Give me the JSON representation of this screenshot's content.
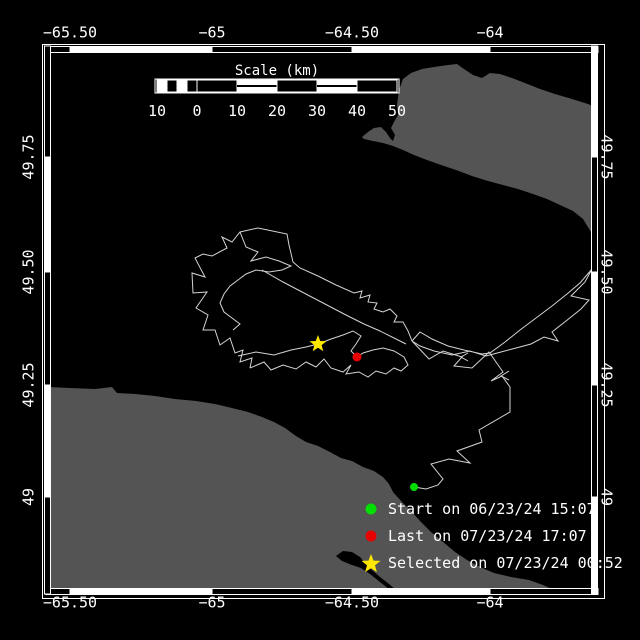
{
  "map": {
    "colors": {
      "background": "#000000",
      "land": "#545454",
      "lake": "#000000",
      "track": "#d4d4d4",
      "frame": "#ffffff",
      "start_marker": "#00dd00",
      "last_marker": "#e80000",
      "selected_marker": "#ffe800"
    },
    "axis": {
      "x_ticks": [
        {
          "label": "−65.50",
          "px": 70
        },
        {
          "label": "−65",
          "px": 212
        },
        {
          "label": "−64.50",
          "px": 352
        },
        {
          "label": "−64",
          "px": 490
        }
      ],
      "y_ticks": [
        {
          "label": "49.75",
          "px": 157
        },
        {
          "label": "49.50",
          "px": 272
        },
        {
          "label": "49.25",
          "px": 385
        },
        {
          "label": "49",
          "px": 497
        }
      ]
    },
    "frame": {
      "outer": [
        42,
        44,
        604,
        598
      ],
      "band_thickness": 6,
      "x_bounds": [
        46,
        70,
        212,
        352,
        490,
        598
      ],
      "y_bounds": [
        46,
        157,
        272,
        385,
        497,
        594
      ],
      "top_fills": [
        "B",
        "W",
        "B",
        "W",
        "B"
      ],
      "bottom_fills": [
        "B",
        "W",
        "B",
        "W",
        "B"
      ],
      "left_fills": [
        "B",
        "W",
        "B",
        "W",
        "B"
      ],
      "right_fills": [
        "W",
        "B",
        "W",
        "B",
        "W"
      ]
    },
    "scale_bar": {
      "title": "Scale (km)",
      "x0": 156,
      "x1": 398,
      "y0": 80,
      "y1": 92,
      "title_pos": [
        277,
        71
      ],
      "label_y": 111,
      "tick_labels": [
        {
          "text": "10",
          "px": 157
        },
        {
          "text": "0",
          "px": 197
        },
        {
          "text": "10",
          "px": 237
        },
        {
          "text": "20",
          "px": 277
        },
        {
          "text": "30",
          "px": 317
        },
        {
          "text": "40",
          "px": 357
        },
        {
          "text": "50",
          "px": 397
        }
      ],
      "cells": [
        [
          157,
          167,
          "W"
        ],
        [
          167,
          177,
          "B"
        ],
        [
          177,
          187,
          "W"
        ],
        [
          187,
          197,
          "B"
        ],
        [
          197,
          237,
          "B"
        ],
        [
          237,
          277,
          "WS"
        ],
        [
          277,
          317,
          "B"
        ],
        [
          317,
          357,
          "WS"
        ],
        [
          357,
          397,
          "B"
        ]
      ]
    },
    "legend": [
      {
        "marker": "circle",
        "color": "#00dd00",
        "label": "Start on 06/23/24 15:07"
      },
      {
        "marker": "circle",
        "color": "#e80000",
        "label": "Last on 07/23/24 17:07"
      },
      {
        "marker": "star",
        "color": "#ffe800",
        "label": "Selected on 07/23/24 00:52"
      }
    ],
    "markers": {
      "start": {
        "x": 414,
        "y": 487,
        "r": 4
      },
      "last": {
        "x": 357,
        "y": 357,
        "r": 4.5
      },
      "selected": {
        "x": 318,
        "y": 344,
        "r": 9
      }
    },
    "land": [
      [
        [
          403,
          79
        ],
        [
          411,
          73
        ],
        [
          422,
          69
        ],
        [
          434,
          67
        ],
        [
          448,
          65
        ],
        [
          457,
          64
        ],
        [
          464,
          69
        ],
        [
          473,
          75
        ],
        [
          482,
          78
        ],
        [
          490,
          73
        ],
        [
          500,
          74
        ],
        [
          512,
          78
        ],
        [
          525,
          83
        ],
        [
          540,
          89
        ],
        [
          555,
          94
        ],
        [
          572,
          99
        ],
        [
          588,
          104
        ],
        [
          597,
          108
        ],
        [
          597,
          255
        ],
        [
          591,
          232
        ],
        [
          583,
          219
        ],
        [
          573,
          211
        ],
        [
          560,
          205
        ],
        [
          547,
          199
        ],
        [
          533,
          194
        ],
        [
          518,
          189
        ],
        [
          503,
          185
        ],
        [
          488,
          181
        ],
        [
          472,
          176
        ],
        [
          456,
          170
        ],
        [
          441,
          165
        ],
        [
          427,
          160
        ],
        [
          414,
          155
        ],
        [
          403,
          150
        ],
        [
          393,
          146
        ],
        [
          383,
          143
        ],
        [
          373,
          141
        ],
        [
          364,
          139
        ],
        [
          362,
          137
        ],
        [
          368,
          132
        ],
        [
          374,
          128
        ],
        [
          381,
          127
        ],
        [
          386,
          132
        ],
        [
          390,
          138
        ],
        [
          393,
          141
        ],
        [
          395,
          135
        ],
        [
          391,
          128
        ],
        [
          394,
          122
        ],
        [
          398,
          115
        ],
        [
          397,
          105
        ],
        [
          399,
          90
        ]
      ],
      [
        [
          48,
          387
        ],
        [
          70,
          388
        ],
        [
          95,
          389
        ],
        [
          112,
          387
        ],
        [
          117,
          393
        ],
        [
          135,
          394
        ],
        [
          155,
          396
        ],
        [
          175,
          399
        ],
        [
          196,
          401
        ],
        [
          215,
          404
        ],
        [
          232,
          408
        ],
        [
          248,
          412
        ],
        [
          262,
          417
        ],
        [
          274,
          422
        ],
        [
          285,
          428
        ],
        [
          296,
          436
        ],
        [
          306,
          442
        ],
        [
          318,
          446
        ],
        [
          330,
          452
        ],
        [
          341,
          458
        ],
        [
          352,
          461
        ],
        [
          363,
          467
        ],
        [
          374,
          471
        ],
        [
          383,
          477
        ],
        [
          389,
          484
        ],
        [
          393,
          492
        ],
        [
          402,
          502
        ],
        [
          411,
          511
        ],
        [
          421,
          522
        ],
        [
          431,
          532
        ],
        [
          442,
          541
        ],
        [
          455,
          552
        ],
        [
          467,
          560
        ],
        [
          480,
          567
        ],
        [
          494,
          573
        ],
        [
          511,
          577
        ],
        [
          529,
          580
        ],
        [
          543,
          585
        ],
        [
          552,
          589
        ],
        [
          556,
          592
        ],
        [
          48,
          592
        ]
      ]
    ],
    "lakes": [
      [
        [
          336,
          556
        ],
        [
          343,
          551
        ],
        [
          352,
          552
        ],
        [
          360,
          557
        ],
        [
          366,
          564
        ],
        [
          372,
          570
        ],
        [
          380,
          577
        ],
        [
          389,
          584
        ],
        [
          396,
          590
        ],
        [
          390,
          590
        ],
        [
          380,
          582
        ],
        [
          370,
          574
        ],
        [
          361,
          568
        ],
        [
          352,
          565
        ],
        [
          342,
          561
        ]
      ]
    ],
    "track": [
      [
        [
          414,
          487
        ],
        [
          426,
          489
        ],
        [
          438,
          485
        ],
        [
          443,
          479
        ],
        [
          431,
          464
        ],
        [
          449,
          459
        ],
        [
          470,
          463
        ],
        [
          457,
          451
        ],
        [
          482,
          442
        ],
        [
          479,
          430
        ],
        [
          510,
          412
        ],
        [
          510,
          387
        ],
        [
          502,
          376
        ],
        [
          491,
          381
        ],
        [
          503,
          372
        ],
        [
          489,
          352
        ],
        [
          472,
          368
        ],
        [
          454,
          366
        ],
        [
          462,
          357
        ],
        [
          443,
          351
        ],
        [
          429,
          359
        ],
        [
          412,
          341
        ]
      ],
      [
        [
          412,
          341
        ],
        [
          420,
          332
        ],
        [
          432,
          339
        ],
        [
          448,
          346
        ],
        [
          464,
          350
        ],
        [
          482,
          354
        ],
        [
          490,
          353
        ],
        [
          505,
          342
        ],
        [
          520,
          330
        ],
        [
          536,
          318
        ],
        [
          552,
          306
        ],
        [
          567,
          294
        ],
        [
          580,
          283
        ],
        [
          592,
          269
        ],
        [
          585,
          282
        ],
        [
          571,
          296
        ],
        [
          589,
          300
        ],
        [
          581,
          309
        ],
        [
          566,
          321
        ],
        [
          552,
          332
        ],
        [
          558,
          341
        ],
        [
          544,
          337
        ],
        [
          531,
          344
        ],
        [
          516,
          348
        ],
        [
          501,
          352
        ],
        [
          486,
          356
        ],
        [
          470,
          351
        ],
        [
          452,
          355
        ],
        [
          434,
          351
        ],
        [
          420,
          346
        ],
        [
          412,
          341
        ]
      ],
      [
        [
          258,
          228
        ],
        [
          287,
          234
        ],
        [
          289,
          245
        ],
        [
          293,
          262
        ],
        [
          300,
          268
        ],
        [
          318,
          276
        ],
        [
          336,
          285
        ],
        [
          354,
          293
        ],
        [
          362,
          291
        ],
        [
          360,
          298
        ],
        [
          370,
          295
        ],
        [
          368,
          302
        ],
        [
          377,
          303
        ],
        [
          374,
          309
        ],
        [
          383,
          312
        ],
        [
          390,
          309
        ],
        [
          397,
          316
        ],
        [
          394,
          322
        ],
        [
          403,
          322
        ],
        [
          408,
          331
        ],
        [
          412,
          341
        ]
      ],
      [
        [
          262,
          270
        ],
        [
          283,
          282
        ],
        [
          304,
          293
        ],
        [
          325,
          304
        ],
        [
          346,
          315
        ],
        [
          364,
          324
        ],
        [
          380,
          331
        ],
        [
          394,
          338
        ],
        [
          406,
          344
        ]
      ],
      [
        [
          258,
          228
        ],
        [
          240,
          232
        ],
        [
          232,
          242
        ],
        [
          222,
          237
        ],
        [
          227,
          248
        ],
        [
          212,
          256
        ],
        [
          203,
          254
        ],
        [
          195,
          258
        ],
        [
          205,
          277
        ],
        [
          192,
          273
        ],
        [
          193,
          293
        ],
        [
          207,
          292
        ],
        [
          196,
          308
        ],
        [
          208,
          315
        ],
        [
          203,
          330
        ],
        [
          215,
          330
        ],
        [
          220,
          345
        ],
        [
          230,
          338
        ],
        [
          235,
          353
        ],
        [
          243,
          350
        ],
        [
          240,
          362
        ],
        [
          252,
          358
        ],
        [
          250,
          368
        ]
      ],
      [
        [
          240,
          232
        ],
        [
          246,
          247
        ],
        [
          258,
          252
        ],
        [
          251,
          261
        ],
        [
          266,
          257
        ],
        [
          279,
          261
        ],
        [
          291,
          266
        ],
        [
          282,
          270
        ],
        [
          269,
          272
        ],
        [
          256,
          270
        ],
        [
          246,
          274
        ],
        [
          238,
          280
        ],
        [
          230,
          286
        ],
        [
          224,
          294
        ],
        [
          220,
          303
        ],
        [
          224,
          312
        ],
        [
          232,
          318
        ],
        [
          240,
          324
        ],
        [
          233,
          330
        ]
      ],
      [
        [
          250,
          368
        ],
        [
          264,
          362
        ],
        [
          271,
          370
        ],
        [
          283,
          365
        ],
        [
          296,
          369
        ],
        [
          306,
          362
        ],
        [
          316,
          367
        ],
        [
          324,
          359
        ],
        [
          331,
          368
        ],
        [
          343,
          372
        ],
        [
          351,
          365
        ],
        [
          346,
          374
        ],
        [
          359,
          372
        ],
        [
          368,
          377
        ],
        [
          376,
          371
        ],
        [
          386,
          374
        ],
        [
          394,
          368
        ],
        [
          401,
          371
        ],
        [
          408,
          365
        ],
        [
          404,
          357
        ],
        [
          394,
          351
        ],
        [
          383,
          348
        ],
        [
          373,
          350
        ],
        [
          363,
          353
        ],
        [
          357,
          357
        ]
      ],
      [
        [
          238,
          356
        ],
        [
          256,
          352
        ],
        [
          274,
          355
        ],
        [
          291,
          350
        ],
        [
          306,
          347
        ],
        [
          318,
          344
        ],
        [
          331,
          339
        ],
        [
          343,
          335
        ],
        [
          353,
          331
        ],
        [
          361,
          336
        ],
        [
          356,
          344
        ],
        [
          351,
          351
        ],
        [
          357,
          357
        ]
      ],
      [
        [
          468,
          353
        ],
        [
          461,
          357
        ],
        [
          468,
          361
        ]
      ],
      [
        [
          509,
          371
        ],
        [
          501,
          376
        ],
        [
          509,
          380
        ]
      ]
    ]
  }
}
